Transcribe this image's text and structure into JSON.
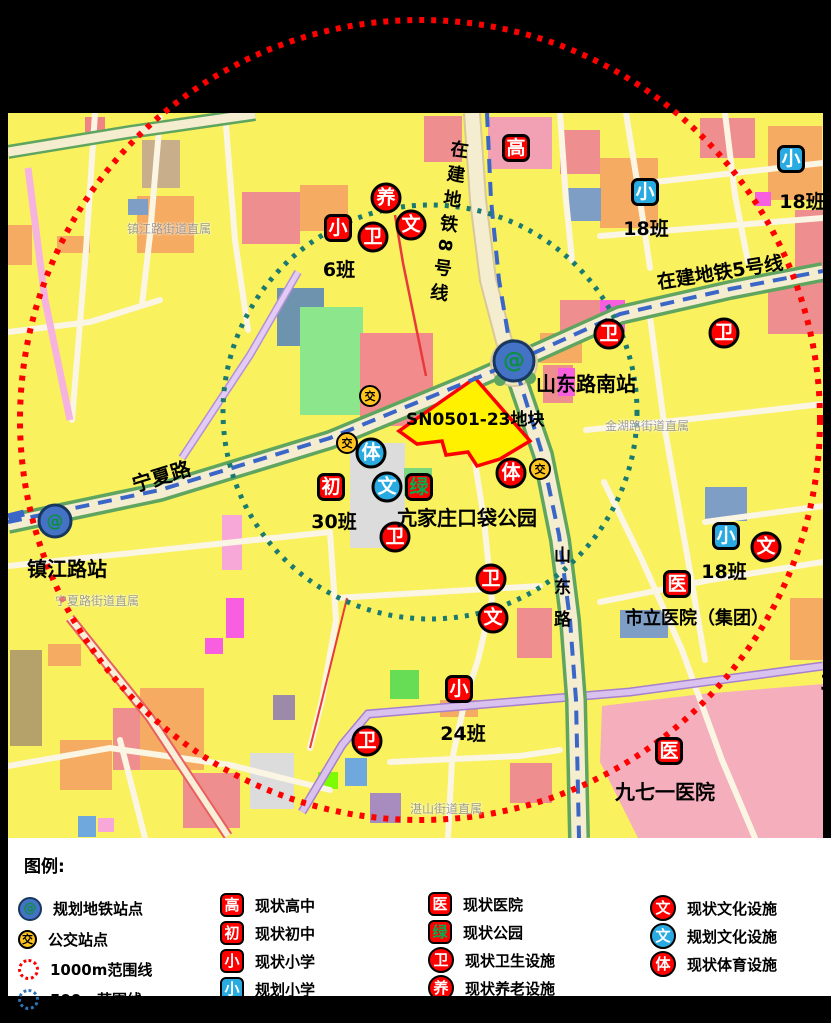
{
  "palette": {
    "red": "#FE0000",
    "blue": "#29ABE2",
    "green_text": "#00B050",
    "bus_yellow": "#FFC41E",
    "metro_blue": "#3A66C8",
    "range_red": "#FF0000",
    "range_teal": "#1A7A70",
    "legend_blue": "#2E75B6",
    "metro_fill": "#4472C4",
    "metro_ring": "#17375E",
    "metro_glyph": "#0C8F3F",
    "plot_yellow": "#FFF100"
  },
  "icons": {
    "metro_glyph": "@",
    "bus_glyph": "交"
  },
  "map": {
    "stations": [
      {
        "name": "shandong-road-south-station",
        "label": "山东路南站",
        "x": 514,
        "y": 361,
        "size": "metro-big",
        "label_x": 536,
        "label_y": 368,
        "label_size": 20
      },
      {
        "name": "zhenjiang-road-station",
        "label": "镇江路站",
        "x": 55,
        "y": 521,
        "size": "metro-small",
        "label_x": 27,
        "label_y": 553,
        "label_size": 20
      }
    ],
    "markers": [
      {
        "t": "高",
        "k": "sq",
        "c": "red",
        "x": 516,
        "y": 148,
        "name": "marker-high-school"
      },
      {
        "t": "小",
        "k": "sq",
        "c": "blue",
        "x": 645,
        "y": 192,
        "name": "marker-planned-primary-school"
      },
      {
        "t": "小",
        "k": "sq",
        "c": "blue",
        "x": 791,
        "y": 159,
        "name": "marker-planned-primary-school"
      },
      {
        "t": "小",
        "k": "sq",
        "c": "red",
        "x": 338,
        "y": 228,
        "name": "marker-primary-school"
      },
      {
        "t": "初",
        "k": "sq",
        "c": "red",
        "x": 331,
        "y": 487,
        "name": "marker-middle-school"
      },
      {
        "t": "绿",
        "k": "sq",
        "c": "red",
        "tc": "green",
        "x": 419,
        "y": 487,
        "name": "marker-park"
      },
      {
        "t": "医",
        "k": "sq",
        "c": "red",
        "x": 677,
        "y": 584,
        "name": "marker-hospital"
      },
      {
        "t": "医",
        "k": "sq",
        "c": "red",
        "x": 669,
        "y": 751,
        "name": "marker-hospital"
      },
      {
        "t": "小",
        "k": "sq",
        "c": "red",
        "x": 459,
        "y": 689,
        "name": "marker-primary-school"
      },
      {
        "t": "小",
        "k": "sq",
        "c": "blue",
        "x": 726,
        "y": 536,
        "name": "marker-planned-primary-school"
      },
      {
        "t": "养",
        "k": "ci",
        "c": "red",
        "x": 386,
        "y": 198,
        "name": "marker-elder-care"
      },
      {
        "t": "卫",
        "k": "ci",
        "c": "red",
        "x": 373,
        "y": 237,
        "name": "marker-health-facility"
      },
      {
        "t": "文",
        "k": "ci",
        "c": "red",
        "x": 411,
        "y": 225,
        "name": "marker-culture-facility"
      },
      {
        "t": "卫",
        "k": "ci",
        "c": "red",
        "x": 609,
        "y": 334,
        "name": "marker-health-facility"
      },
      {
        "t": "卫",
        "k": "ci",
        "c": "red",
        "x": 724,
        "y": 333,
        "name": "marker-health-facility"
      },
      {
        "t": "体",
        "k": "ci",
        "c": "blue",
        "x": 371,
        "y": 453,
        "name": "marker-planned-sports-facility"
      },
      {
        "t": "文",
        "k": "ci",
        "c": "blue",
        "x": 387,
        "y": 487,
        "name": "marker-planned-culture-facility"
      },
      {
        "t": "体",
        "k": "ci",
        "c": "red",
        "x": 511,
        "y": 473,
        "name": "marker-sports-facility"
      },
      {
        "t": "卫",
        "k": "ci",
        "c": "red",
        "x": 395,
        "y": 537,
        "name": "marker-health-facility"
      },
      {
        "t": "卫",
        "k": "ci",
        "c": "red",
        "x": 491,
        "y": 579,
        "name": "marker-health-facility"
      },
      {
        "t": "文",
        "k": "ci",
        "c": "red",
        "x": 493,
        "y": 618,
        "name": "marker-culture-facility"
      },
      {
        "t": "文",
        "k": "ci",
        "c": "red",
        "x": 766,
        "y": 547,
        "name": "marker-culture-facility"
      },
      {
        "t": "卫",
        "k": "ci",
        "c": "red",
        "x": 367,
        "y": 741,
        "name": "marker-health-facility"
      }
    ],
    "bus_stops": [
      {
        "x": 370,
        "y": 396
      },
      {
        "x": 347,
        "y": 443
      },
      {
        "x": 540,
        "y": 469
      }
    ],
    "labels": [
      {
        "text": "SN0501-23地块",
        "x": 406,
        "y": 405,
        "size": 17,
        "name": "plot-label"
      },
      {
        "text": "亢家庄口袋公园",
        "x": 397,
        "y": 502,
        "size": 20,
        "name": "pocket-park-label"
      },
      {
        "text": "市立医院（集团）",
        "x": 625,
        "y": 604,
        "size": 18,
        "name": "municipal-hospital-label"
      },
      {
        "text": "九七一医院",
        "x": 615,
        "y": 776,
        "size": 20,
        "name": "971-hospital-label"
      },
      {
        "text": "宁夏路",
        "x": 128,
        "y": 470,
        "size": 20,
        "rotate": -17,
        "name": "ningxia-road-label"
      },
      {
        "text": "在建地铁5号线",
        "x": 655,
        "y": 268,
        "size": 19,
        "rotate": -9,
        "name": "metro-line5-label"
      },
      {
        "text": "在建地铁8号线",
        "x": 446,
        "y": 138,
        "size": 18,
        "vertical": true,
        "rotate": 8,
        "spacing": 7,
        "name": "metro-line8-label"
      },
      {
        "text": "山东路",
        "x": 548,
        "y": 546,
        "size": 17,
        "vertical": true,
        "spacing": 15,
        "name": "shandong-road-label"
      },
      {
        "text": "3",
        "x": 820,
        "y": 671,
        "size": 21,
        "name": "edge-cut-label"
      }
    ],
    "class_labels": [
      {
        "text": "6班",
        "x": 339,
        "y": 265
      },
      {
        "text": "18班",
        "x": 646,
        "y": 224
      },
      {
        "text": "18班",
        "x": 802,
        "y": 197
      },
      {
        "text": "30班",
        "x": 334,
        "y": 517
      },
      {
        "text": "24班",
        "x": 463,
        "y": 729
      },
      {
        "text": "18班",
        "x": 724,
        "y": 567
      }
    ],
    "watermarks": [
      {
        "text": "镇江路街道直属",
        "x": 127,
        "y": 220
      },
      {
        "text": "宁夏路街道直属",
        "x": 55,
        "y": 592
      },
      {
        "text": "金湖路街道直属",
        "x": 605,
        "y": 417
      },
      {
        "text": "湛山街道直属",
        "x": 410,
        "y": 800
      }
    ]
  },
  "legend": {
    "title": "图例:",
    "columns": [
      {
        "x": 10,
        "top": 54,
        "rows": [
          {
            "icon": "metro-station-icon",
            "style": "metro",
            "label": "规划地铁站点",
            "h": 33
          },
          {
            "icon": "bus-stop-icon",
            "style": "bus",
            "label": "公交站点",
            "h": 29
          },
          {
            "icon": "red-dotted-circle-icon",
            "style": "dot-red",
            "label": "1000m范围线",
            "h": 30
          },
          {
            "icon": "blue-dotted-circle-icon",
            "style": "dot-blue",
            "label": "500m范围线",
            "h": 30,
            "raise": true
          }
        ]
      },
      {
        "x": 212,
        "top": 53,
        "rows": [
          {
            "glyph": "高",
            "style": "sq-red",
            "label": "现状高中",
            "h": 28
          },
          {
            "glyph": "初",
            "style": "sq-red",
            "label": "现状初中",
            "h": 28
          },
          {
            "glyph": "小",
            "style": "sq-red",
            "label": "现状小学",
            "h": 28
          },
          {
            "glyph": "小",
            "style": "sq-blue",
            "label": "规划小学",
            "h": 28
          }
        ]
      },
      {
        "x": 420,
        "top": 52,
        "rows": [
          {
            "glyph": "医",
            "style": "sq-red",
            "label": "现状医院",
            "h": 28
          },
          {
            "glyph": "绿",
            "style": "sq-red-green",
            "label": "现状公园",
            "h": 28
          },
          {
            "glyph": "卫",
            "style": "ci-red",
            "label": "现状卫生设施",
            "h": 28
          },
          {
            "glyph": "养",
            "style": "ci-red",
            "label": "现状养老设施",
            "h": 28
          }
        ]
      },
      {
        "x": 642,
        "top": 56,
        "rows": [
          {
            "glyph": "文",
            "style": "ci-red",
            "label": "现状文化设施",
            "h": 28
          },
          {
            "glyph": "文",
            "style": "ci-blue",
            "label": "规划文化设施",
            "h": 28
          },
          {
            "glyph": "体",
            "style": "ci-red",
            "label": "现状体育设施",
            "h": 28
          }
        ]
      }
    ]
  }
}
